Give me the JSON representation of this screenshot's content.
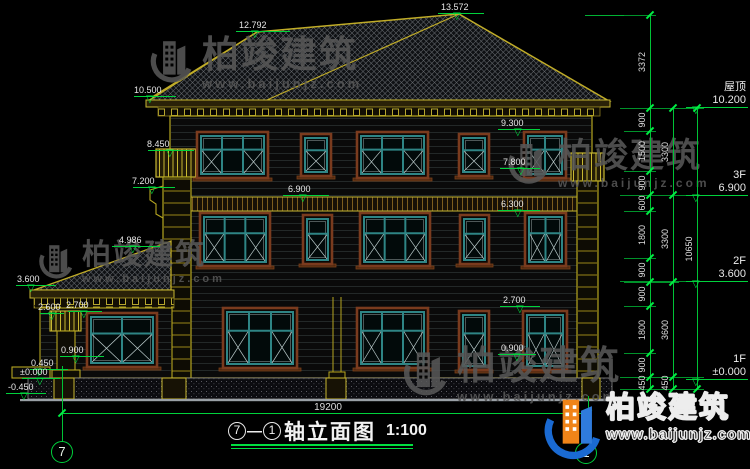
{
  "drawing": {
    "title": {
      "axis_start": "7",
      "separator": "—",
      "axis_end": "1",
      "name": "轴立面图",
      "scale": "1:100"
    },
    "total_width_dim": "19200",
    "axes": {
      "left": "7",
      "right": "1"
    }
  },
  "levels_right": [
    {
      "label": "屋顶",
      "value": "10.200"
    },
    {
      "label": "3F",
      "value": "6.900"
    },
    {
      "label": "2F",
      "value": "3.600"
    },
    {
      "label": "1F",
      "value": "±0.000"
    }
  ],
  "markers": [
    {
      "label": "13.572"
    },
    {
      "label": "12.792"
    },
    {
      "label": "10.500"
    },
    {
      "label": "9.300"
    },
    {
      "label": "8.450"
    },
    {
      "label": "7.800"
    },
    {
      "label": "7.200"
    },
    {
      "label": "6.900"
    },
    {
      "label": "6.300"
    },
    {
      "label": "4.986"
    },
    {
      "label": "3.600"
    },
    {
      "label": "2.700"
    },
    {
      "label": "2.600"
    },
    {
      "label": "2.700"
    },
    {
      "label": "0.900"
    },
    {
      "label": "0.900"
    },
    {
      "label": "0.450"
    },
    {
      "label": "±0.000"
    },
    {
      "label": "-0.450"
    }
  ],
  "dim_chains": {
    "inner": [
      "3372",
      "900",
      "1500",
      "900",
      "600",
      "1800",
      "900",
      "900",
      "1800",
      "900",
      "450"
    ],
    "middle": [
      "3300",
      "3300",
      "3600",
      "450"
    ],
    "outer": [
      "10650"
    ]
  },
  "watermark": {
    "brand": "柏竣建筑",
    "url": "www.baijunjz.com"
  },
  "logo": {
    "brand": "柏竣建筑",
    "url": "www.baijunjz.com"
  },
  "colors": {
    "dim_green": "#00d23c",
    "cad_yellow": "#b5a520",
    "window_teal": "#2e8585",
    "logo_blue": "#1a6ad2",
    "logo_orange": "#f08418"
  }
}
